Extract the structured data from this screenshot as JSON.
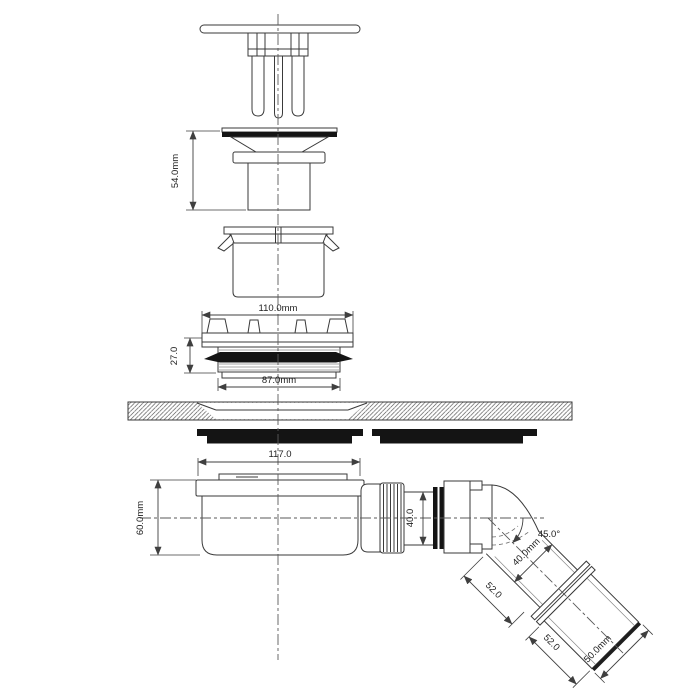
{
  "page": {
    "background": "#ffffff",
    "line_color": "#3a3a3a",
    "seal_color": "#141414"
  },
  "labels": {
    "flange_assembly_height": "54.0mm",
    "flange_top_width": "110.0mm",
    "locknut_height": "27.0",
    "thread_diameter": "87.0mm",
    "trap_top_width": "117.0",
    "trap_body_height": "60.0mm",
    "outlet_spigot_diameter": "40.0",
    "elbow_angle": "45.0°",
    "elbow_pipe_diameter": "40.0mm",
    "elbow_segment1_length": "52.0",
    "elbow_segment2_length": "52.0",
    "pipe_end_diameter": "50.0mm"
  }
}
